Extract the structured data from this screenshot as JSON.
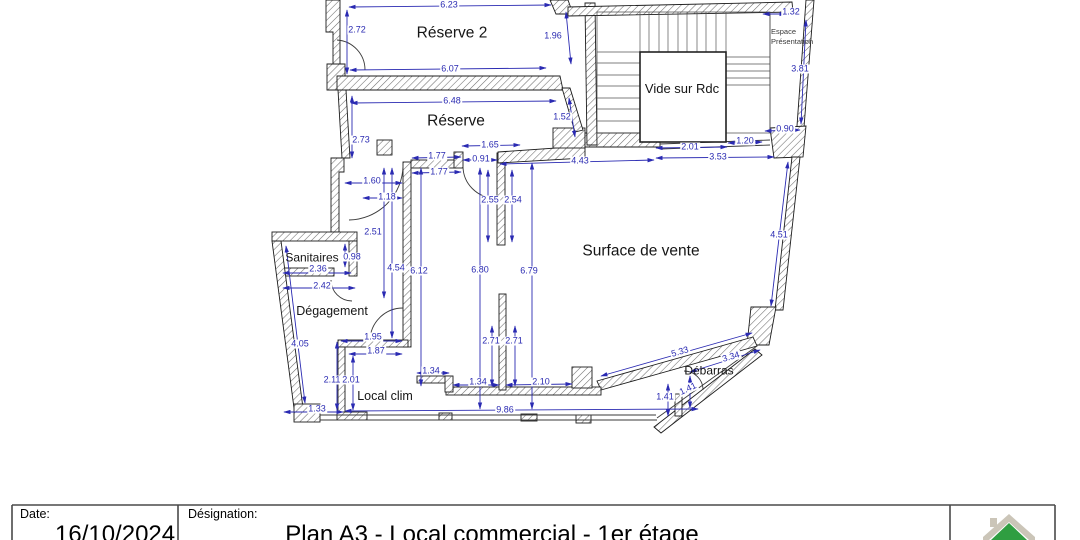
{
  "plan": {
    "rooms": [
      {
        "label": "Réserve 2",
        "x": 452,
        "y": 33,
        "fs": 15.5
      },
      {
        "label": "Réserve",
        "x": 456,
        "y": 121,
        "fs": 15.5
      },
      {
        "label": "Vide sur Rdc",
        "x": 682,
        "y": 89,
        "fs": 13
      },
      {
        "label": "Espace\nPrésentation",
        "x": 771,
        "y": 27,
        "fs": 7.5,
        "align": "left"
      },
      {
        "label": "Surface de vente",
        "x": 641,
        "y": 251,
        "fs": 15.5
      },
      {
        "label": "Sanitaires",
        "x": 312,
        "y": 258,
        "fs": 12
      },
      {
        "label": "Dégagement",
        "x": 332,
        "y": 312,
        "fs": 12.5
      },
      {
        "label": "Local clim",
        "x": 385,
        "y": 397,
        "fs": 12.5
      },
      {
        "label": "Débarras",
        "x": 709,
        "y": 371,
        "fs": 12
      }
    ],
    "dimensions": [
      {
        "v": "6.23",
        "x": 449,
        "y": 5
      },
      {
        "v": "2.72",
        "x": 357,
        "y": 30
      },
      {
        "v": "1.96",
        "x": 553,
        "y": 36
      },
      {
        "v": "6.07",
        "x": 450,
        "y": 69
      },
      {
        "v": "6.48",
        "x": 452,
        "y": 101
      },
      {
        "v": "1.52",
        "x": 562,
        "y": 117
      },
      {
        "v": "2.73",
        "x": 361,
        "y": 140
      },
      {
        "v": "1.32",
        "x": 791,
        "y": 12
      },
      {
        "v": "3.81",
        "x": 800,
        "y": 69
      },
      {
        "v": "0.90",
        "x": 785,
        "y": 129
      },
      {
        "v": "1.20",
        "x": 745,
        "y": 141
      },
      {
        "v": "2.01",
        "x": 690,
        "y": 147
      },
      {
        "v": "3.53",
        "x": 718,
        "y": 157
      },
      {
        "v": "1.65",
        "x": 490,
        "y": 145
      },
      {
        "v": "0.91",
        "x": 481,
        "y": 159
      },
      {
        "v": "1.77",
        "x": 437,
        "y": 156
      },
      {
        "v": "1.77",
        "x": 439,
        "y": 172
      },
      {
        "v": "4.43",
        "x": 580,
        "y": 161
      },
      {
        "v": "1.60",
        "x": 372,
        "y": 181
      },
      {
        "v": "1.18",
        "x": 387,
        "y": 197
      },
      {
        "v": "2.55",
        "x": 490,
        "y": 200
      },
      {
        "v": "2.54",
        "x": 513,
        "y": 200
      },
      {
        "v": "2.51",
        "x": 373,
        "y": 232
      },
      {
        "v": "0.98",
        "x": 352,
        "y": 257
      },
      {
        "v": "2.36",
        "x": 318,
        "y": 269
      },
      {
        "v": "2.42",
        "x": 322,
        "y": 286
      },
      {
        "v": "4.54",
        "x": 396,
        "y": 268
      },
      {
        "v": "6.12",
        "x": 419,
        "y": 271
      },
      {
        "v": "6.80",
        "x": 480,
        "y": 270
      },
      {
        "v": "6.79",
        "x": 529,
        "y": 271
      },
      {
        "v": "4.51",
        "x": 779,
        "y": 235
      },
      {
        "v": "1.95",
        "x": 373,
        "y": 337
      },
      {
        "v": "1.87",
        "x": 376,
        "y": 351
      },
      {
        "v": "4.05",
        "x": 300,
        "y": 344
      },
      {
        "v": "2.71",
        "x": 491,
        "y": 341
      },
      {
        "v": "2.71",
        "x": 514,
        "y": 341
      },
      {
        "v": "5.33",
        "x": 680,
        "y": 352,
        "rot": -16
      },
      {
        "v": "3.34",
        "x": 731,
        "y": 357,
        "rot": -16
      },
      {
        "v": "1.34",
        "x": 431,
        "y": 371
      },
      {
        "v": "1.34",
        "x": 478,
        "y": 382
      },
      {
        "v": "2.10",
        "x": 541,
        "y": 382
      },
      {
        "v": "2.11",
        "x": 332,
        "y": 380
      },
      {
        "v": "2.01",
        "x": 351,
        "y": 380
      },
      {
        "v": "1.41",
        "x": 665,
        "y": 397
      },
      {
        "v": "1.41",
        "x": 688,
        "y": 389,
        "rot": -25
      },
      {
        "v": "1.33",
        "x": 317,
        "y": 409
      },
      {
        "v": "9.86",
        "x": 505,
        "y": 410
      }
    ]
  },
  "title_block": {
    "date_label": "Date:",
    "date_value": "16/10/2024",
    "designation_label": "Désignation:",
    "designation_value": "Plan A3 - Local commercial - 1er étage"
  },
  "colors": {
    "dimension_blue": "#2a2ab2",
    "wall_line": "#1c1c1c",
    "logo_green": "#2f9e41",
    "logo_roof": "#cbc5b8"
  }
}
